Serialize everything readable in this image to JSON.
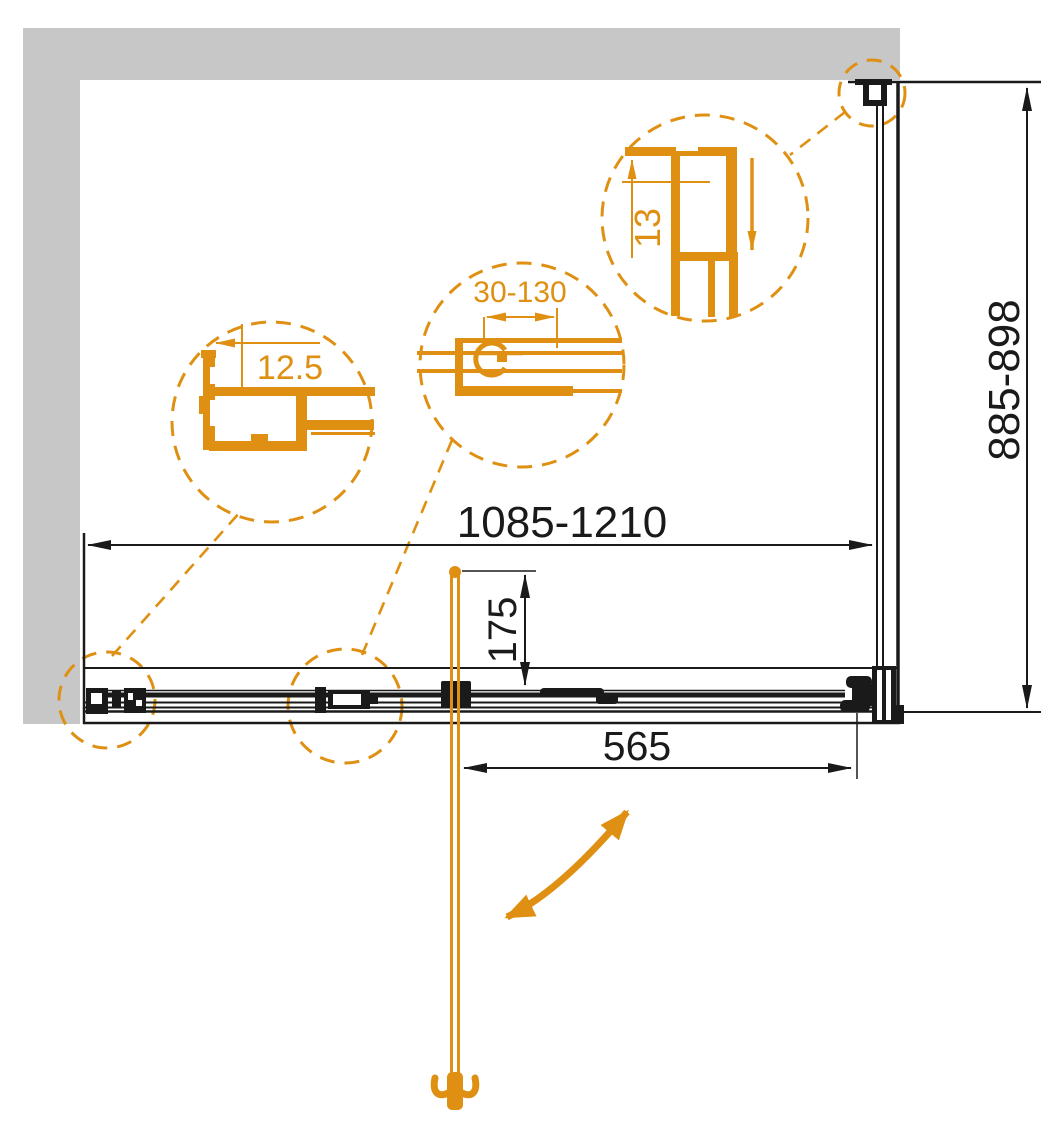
{
  "diagram": {
    "dimensions": {
      "width_range": "1085-1210",
      "depth_range": "885-898",
      "door_width": "565",
      "handle_offset": "175"
    },
    "detail_callouts": {
      "wall_profile_offset": "12.5",
      "adjustment_range": "30-130",
      "profile_width": "13"
    },
    "colors": {
      "accent_orange": "#DF9012",
      "wall_gray": "#C7C7C7",
      "line_black": "#1A1A1A"
    }
  }
}
